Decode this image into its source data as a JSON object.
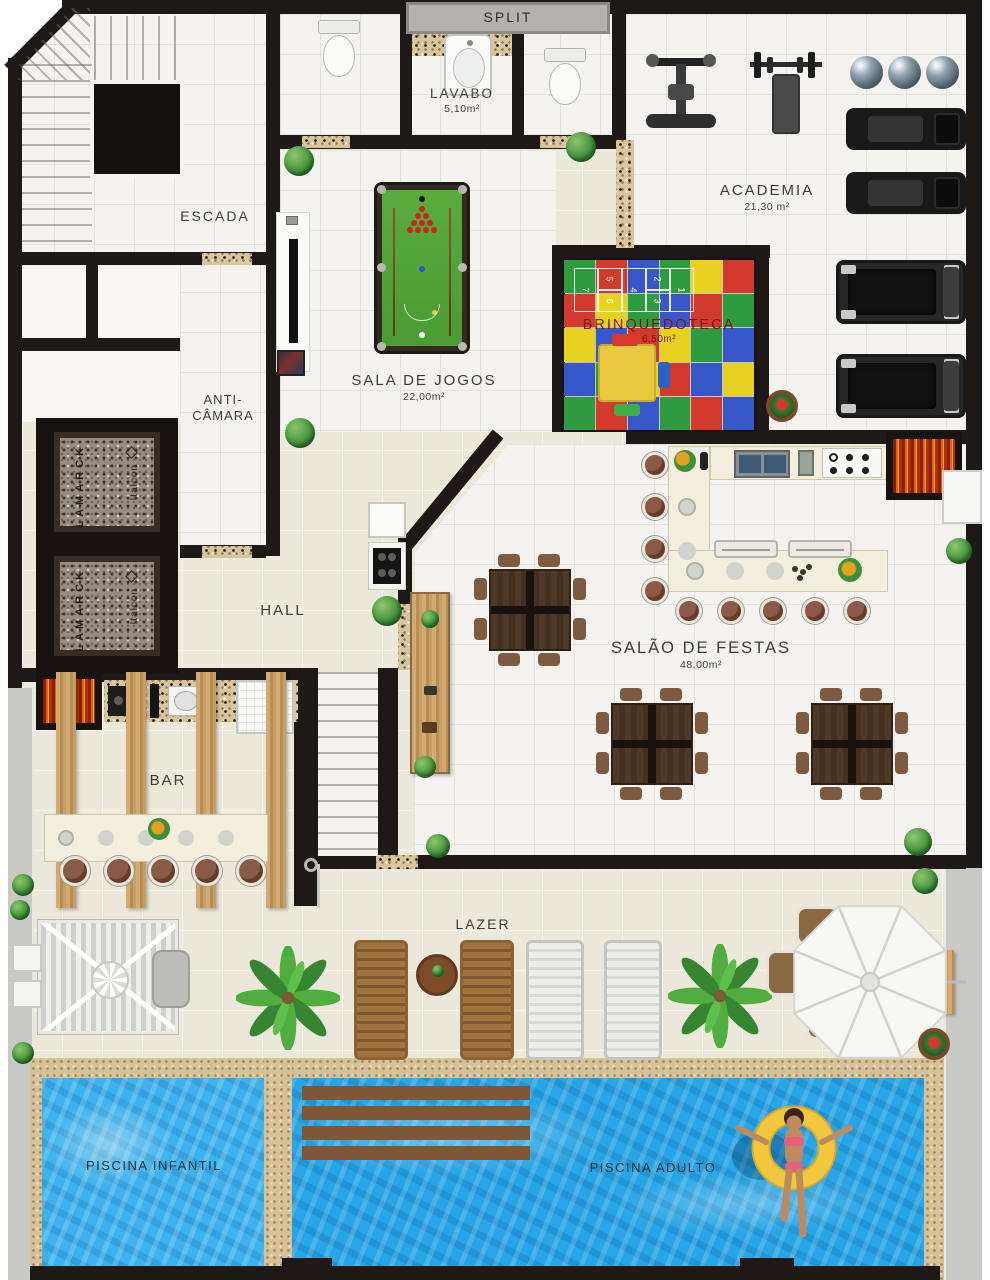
{
  "rooms": {
    "split": {
      "label": "SPLIT"
    },
    "lavabo": {
      "label": "LAVABO",
      "area": "5,10m²"
    },
    "escada": {
      "label": "ESCADA"
    },
    "academia": {
      "label": "ACADEMIA",
      "area": "21,30 m²"
    },
    "sala_de_jogos": {
      "label": "SALA DE JOGOS",
      "area": "22,00m²"
    },
    "brinquedoteca": {
      "label": "BRINQUEDOTECA",
      "area": "6,50m²"
    },
    "anti_camara": {
      "label_line1": "ANTI-",
      "label_line2": "CÂMARA"
    },
    "hall": {
      "label": "HALL"
    },
    "salao_de_festas": {
      "label": "SALÃO DE FESTAS",
      "area": "48,00m²"
    },
    "bar": {
      "label": "BAR"
    },
    "lazer": {
      "label": "LAZER"
    },
    "piscina_infantil": {
      "label": "PISCINA INFANTIL"
    },
    "piscina_adulto": {
      "label": "PISCINA ADULTO"
    }
  },
  "elevators": {
    "brand_primary": "LAMARCK",
    "brand_secondary": "Italcon"
  },
  "brinquedoteca_mat": {
    "colors": [
      "#d23a2e",
      "#3757c9",
      "#2f9b3f",
      "#e7d31f"
    ],
    "pattern": [
      2,
      0,
      1,
      2,
      3,
      0,
      0,
      3,
      2,
      1,
      0,
      2,
      3,
      1,
      0,
      3,
      2,
      1,
      1,
      2,
      3,
      0,
      1,
      3,
      2,
      0,
      1,
      2,
      0,
      1
    ],
    "hopscotch": [
      "1",
      "2",
      "3",
      "4",
      "5",
      "6",
      "7"
    ]
  },
  "colors": {
    "wall": "#1c1916",
    "floor_tile": "#ece8da",
    "water_adult": "#27a5e4",
    "water_kids": "#3db2ec",
    "pool_felt": "#52a838",
    "granite_sill": "#d8c69e",
    "grill_fire": "#d84a16",
    "deck_gray": "#c9c9c5",
    "mat_label": "#7d1512"
  }
}
